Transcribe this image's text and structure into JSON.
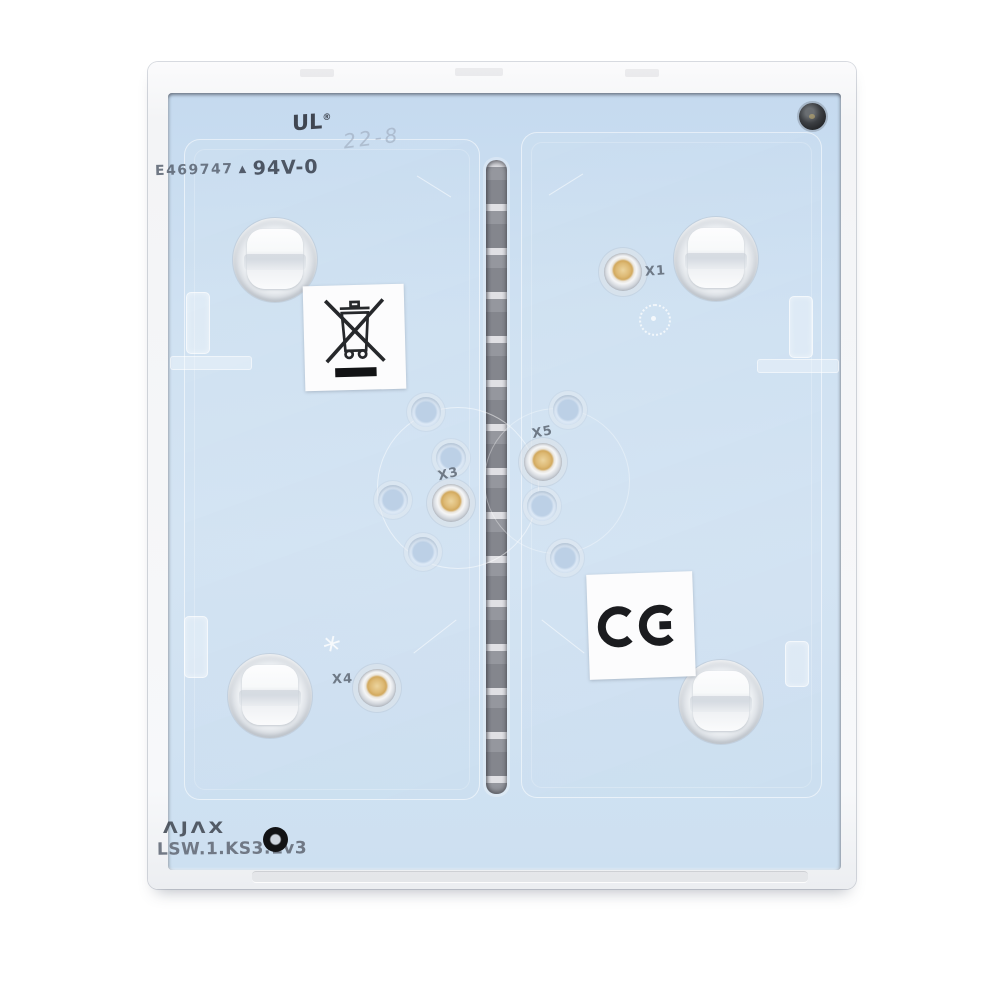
{
  "device": {
    "markings": {
      "ul_file_number": "E469747",
      "mold_triangle": "▲",
      "flammability_rating": "94V-0",
      "ul_mark": "UL",
      "registered_symbol": "®",
      "date_code": "22-8",
      "mold_star": "*"
    },
    "connectors": [
      {
        "id": "X1"
      },
      {
        "id": "X3"
      },
      {
        "id": "X4"
      },
      {
        "id": "X5"
      }
    ],
    "certification": {
      "ce_text": "CE",
      "weee_icon": "crossed-out-wheelie-bin"
    },
    "footer": {
      "brand": "ΛJΛX",
      "model": "LSW.1.KS3.1v3"
    },
    "colors": {
      "plate_blue": "#cfe1f2",
      "frame_white": "#f5f6f8",
      "led_amber": "#d9b26a",
      "slot_gray": "#95979e"
    }
  }
}
